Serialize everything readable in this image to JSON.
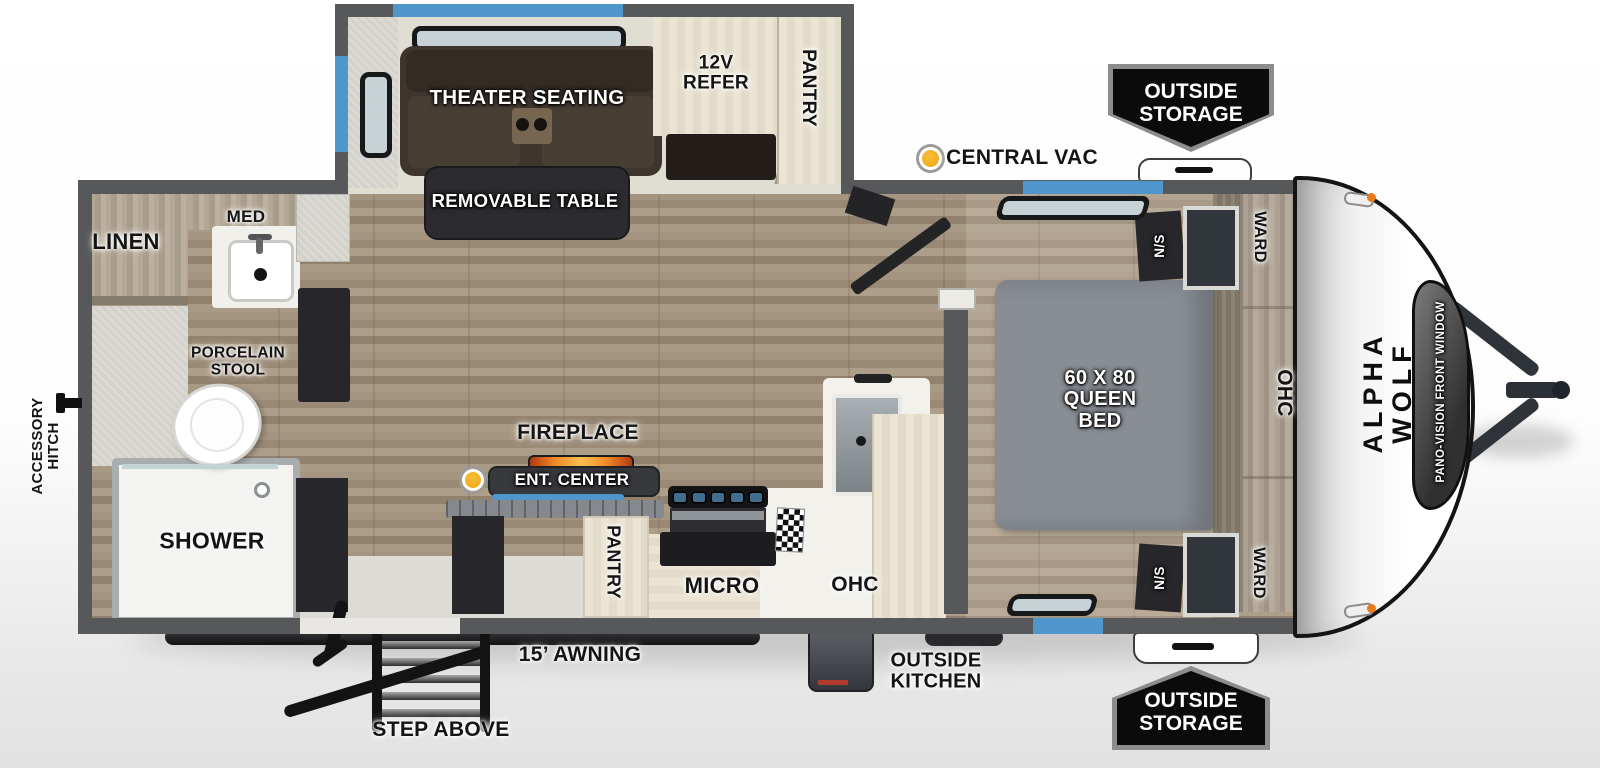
{
  "colors": {
    "accent_blue": "#4f96cc",
    "accent_orange": "#f0a11a",
    "wall_gray": "#57585a",
    "badge_bg": "#0b0b0b",
    "bed_gray": "#898e95",
    "sofa_brown": "#3e362e"
  },
  "exterior": {
    "brand": "ALPHA WOLF",
    "front_window": "PANO-VISION FRONT WINDOW",
    "hitch": "ACCESSORY\nHITCH",
    "storage_top": "OUTSIDE\nSTORAGE",
    "storage_bottom": "OUTSIDE\nSTORAGE",
    "outside_kitchen": "OUTSIDE\nKITCHEN",
    "awning": "15’ AWNING",
    "step": "STEP ABOVE",
    "central_vac": "CENTRAL VAC"
  },
  "slide_out": {
    "theater": "THEATER SEATING",
    "table": "REMOVABLE TABLE",
    "refer": "12V\nREFER",
    "pantry": "PANTRY"
  },
  "kitchen": {
    "fireplace": "FIREPLACE",
    "ent_center": "ENT. CENTER",
    "pantry": "PANTRY",
    "micro": "MICRO",
    "ohc": "OHC"
  },
  "bedroom": {
    "bed": "60 X 80\nQUEEN\nBED",
    "ns_front": "N/S",
    "ns_rear": "N/S",
    "ward_front": "WARD",
    "ward_rear": "WARD",
    "ohc": "OHC"
  },
  "bathroom": {
    "linen": "LINEN",
    "med": "MED",
    "stool": "PORCELAIN\nSTOOL",
    "shower": "SHOWER"
  }
}
